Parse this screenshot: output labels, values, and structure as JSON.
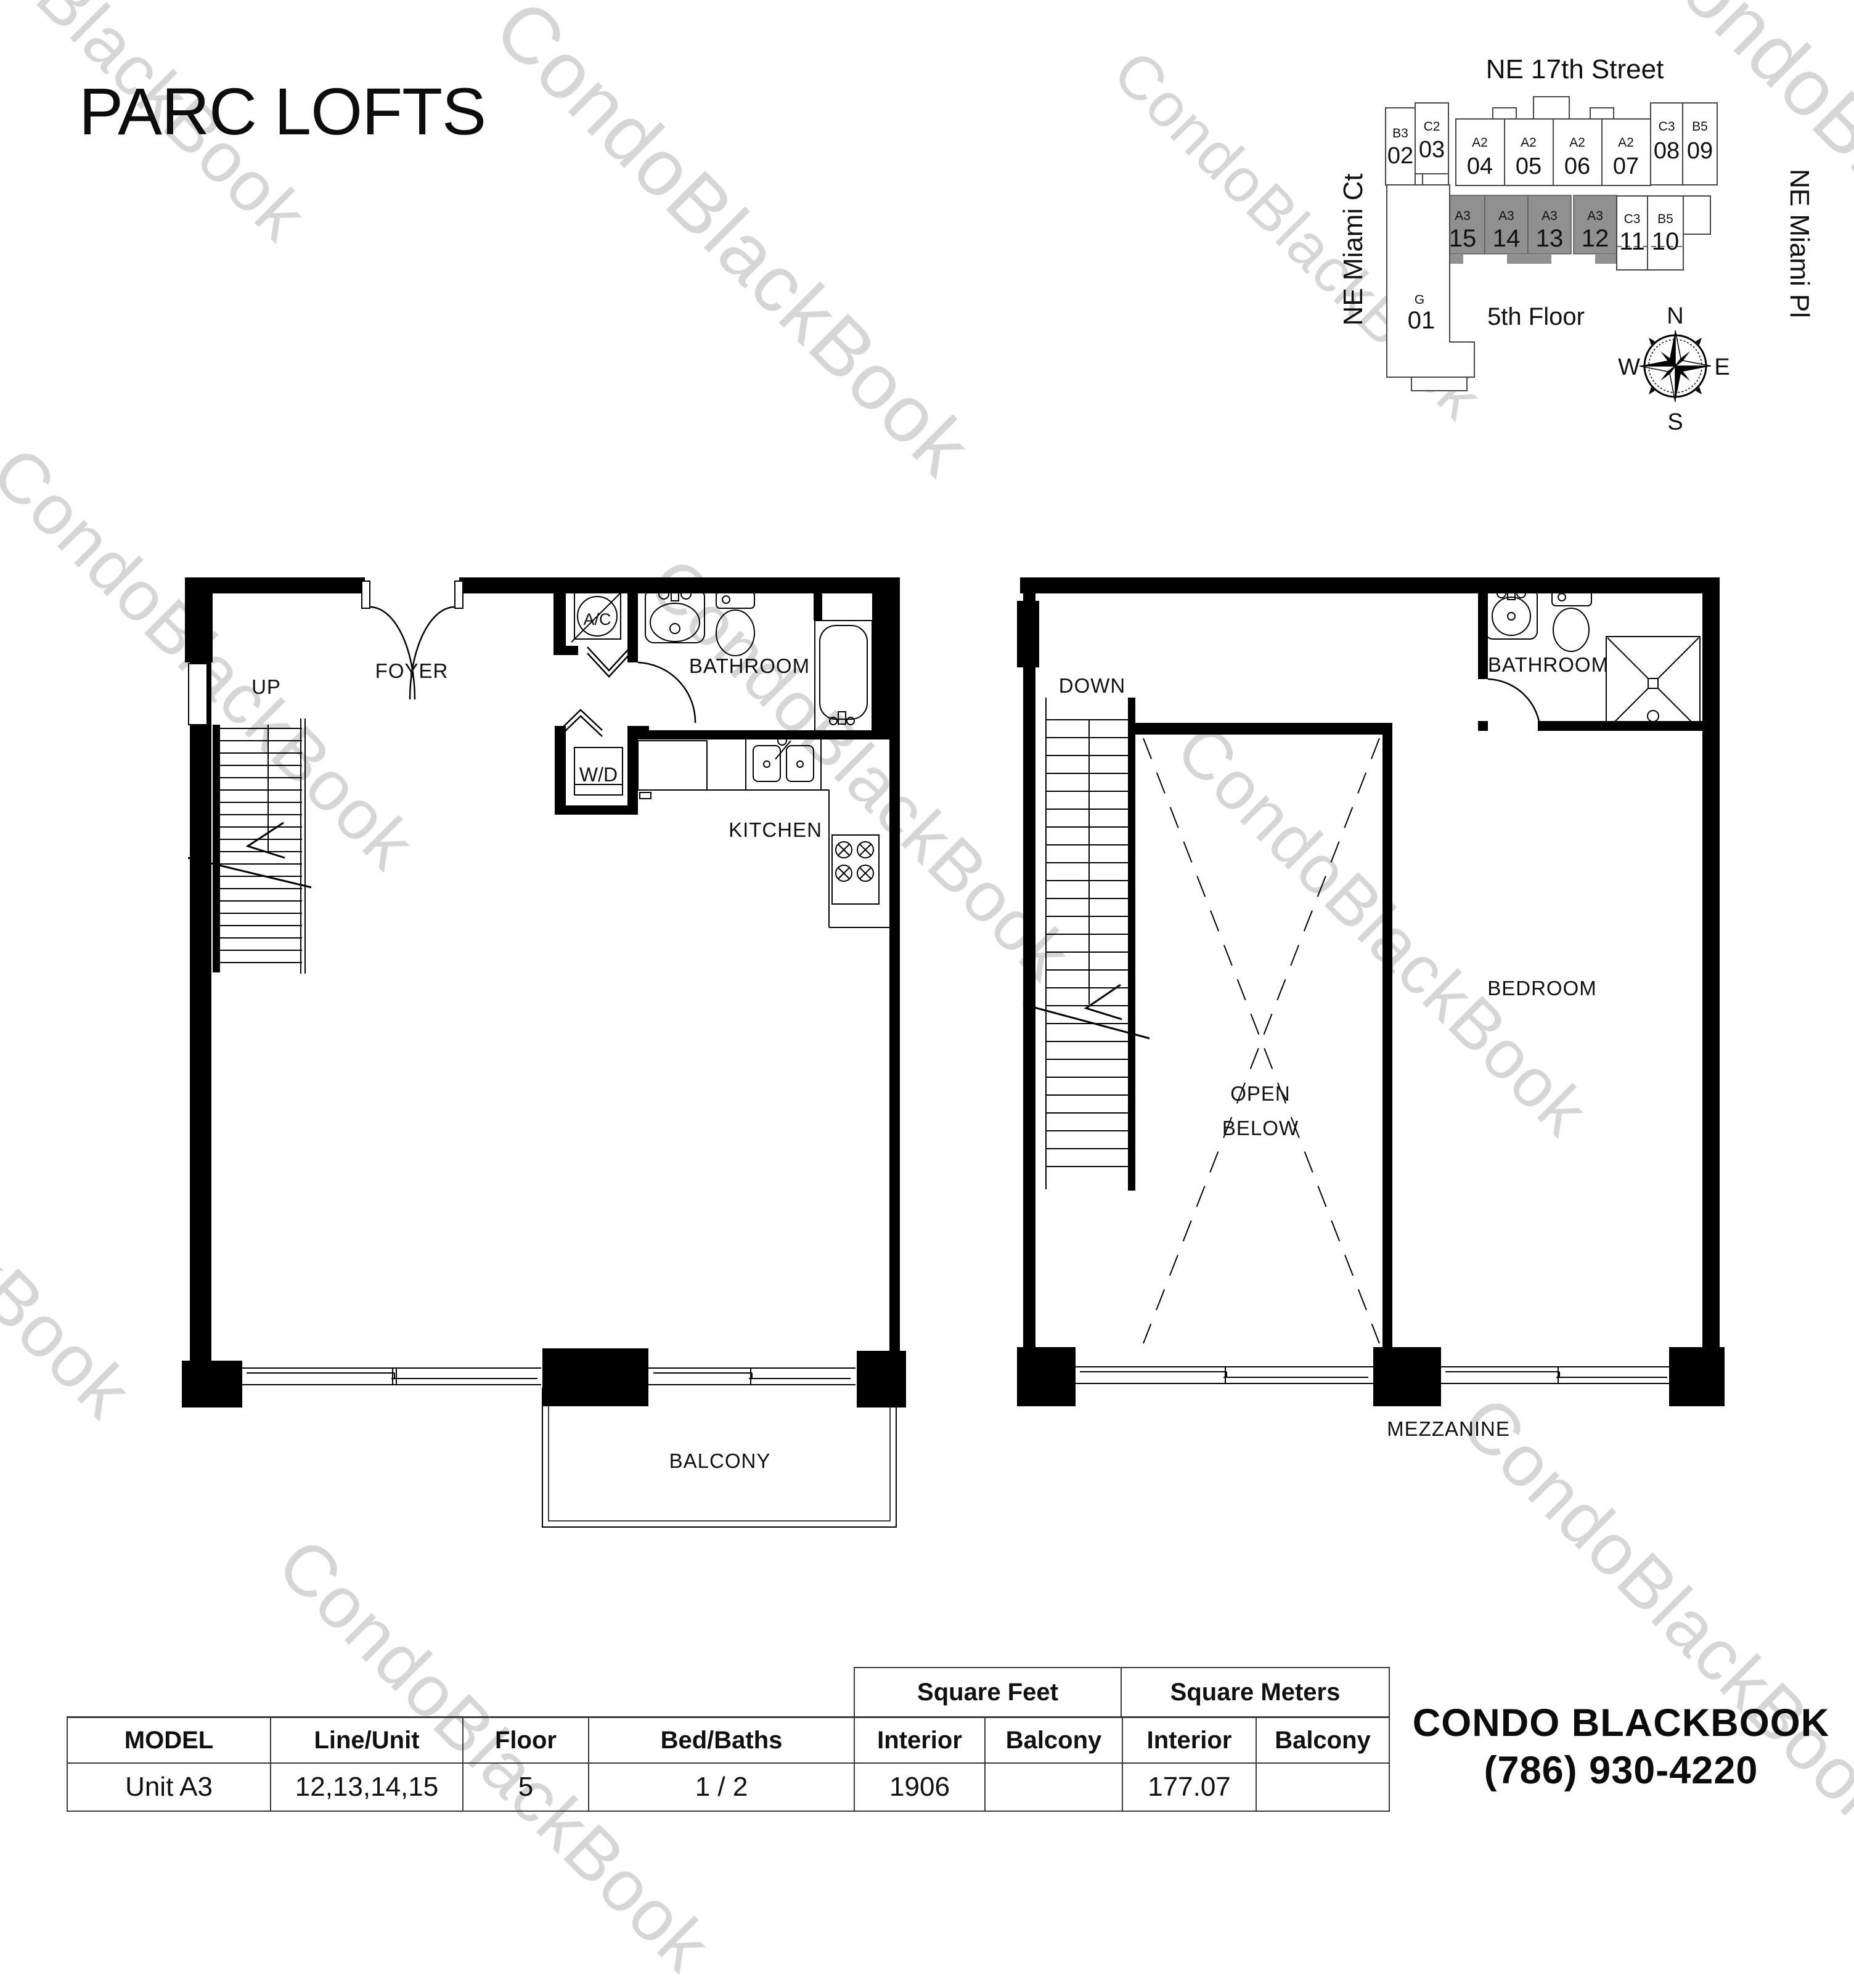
{
  "title": "PARC LOFTS",
  "watermark": {
    "text": "CondoBlackBook"
  },
  "site_plan": {
    "street_top": "NE 17th Street",
    "street_left": "NE Miami Ct",
    "street_right": "NE Miami Pl",
    "floor_label": "5th Floor",
    "compass": {
      "n": "N",
      "e": "E",
      "s": "S",
      "w": "W"
    },
    "units_top": [
      {
        "model": "B3",
        "number": "02"
      },
      {
        "model": "C2",
        "number": "03"
      },
      {
        "model": "A2",
        "number": "04"
      },
      {
        "model": "A2",
        "number": "05"
      },
      {
        "model": "A2",
        "number": "06"
      },
      {
        "model": "A2",
        "number": "07"
      },
      {
        "model": "C3",
        "number": "08"
      },
      {
        "model": "B5",
        "number": "09"
      }
    ],
    "units_mid": [
      {
        "model": "A3",
        "number": "15",
        "highlighted": true
      },
      {
        "model": "A3",
        "number": "14",
        "highlighted": true
      },
      {
        "model": "A3",
        "number": "13",
        "highlighted": true
      },
      {
        "model": "A3",
        "number": "12",
        "highlighted": true
      },
      {
        "model": "C3",
        "number": "11",
        "highlighted": false
      },
      {
        "model": "B5",
        "number": "10",
        "highlighted": false
      }
    ],
    "unit_g": {
      "model": "G",
      "number": "01"
    }
  },
  "plans": {
    "main": {
      "labels": {
        "up": "UP",
        "foyer": "FOYER",
        "ac": "A/C",
        "wd": "W/D",
        "bathroom": "BATHROOM",
        "kitchen": "KITCHEN",
        "balcony": "BALCONY"
      }
    },
    "mezzanine": {
      "labels": {
        "down": "DOWN",
        "bathroom": "BATHROOM",
        "open_below_line1": "OPEN",
        "open_below_line2": "BELOW",
        "bedroom": "BEDROOM",
        "mezzanine": "MEZZANINE"
      }
    }
  },
  "table": {
    "group_headers": {
      "sqft": "Square Feet",
      "sqm": "Square Meters"
    },
    "columns": {
      "model": "MODEL",
      "line_unit": "Line/Unit",
      "floor": "Floor",
      "bed_baths": "Bed/Baths",
      "sqft_interior": "Interior",
      "sqft_balcony": "Balcony",
      "sqm_interior": "Interior",
      "sqm_balcony": "Balcony"
    },
    "row": {
      "model": "Unit A3",
      "line_unit": "12,13,14,15",
      "floor": "5",
      "bed_baths": "1 / 2",
      "sqft_interior": "1906",
      "sqft_balcony": "",
      "sqm_interior": "177.07",
      "sqm_balcony": ""
    }
  },
  "footer": {
    "brand": "CONDO BLACKBOOK",
    "phone": "(786) 930-4220"
  },
  "colors": {
    "unit_highlight": "#909090",
    "watermark": "#d6d6d6",
    "wall": "#000000"
  }
}
